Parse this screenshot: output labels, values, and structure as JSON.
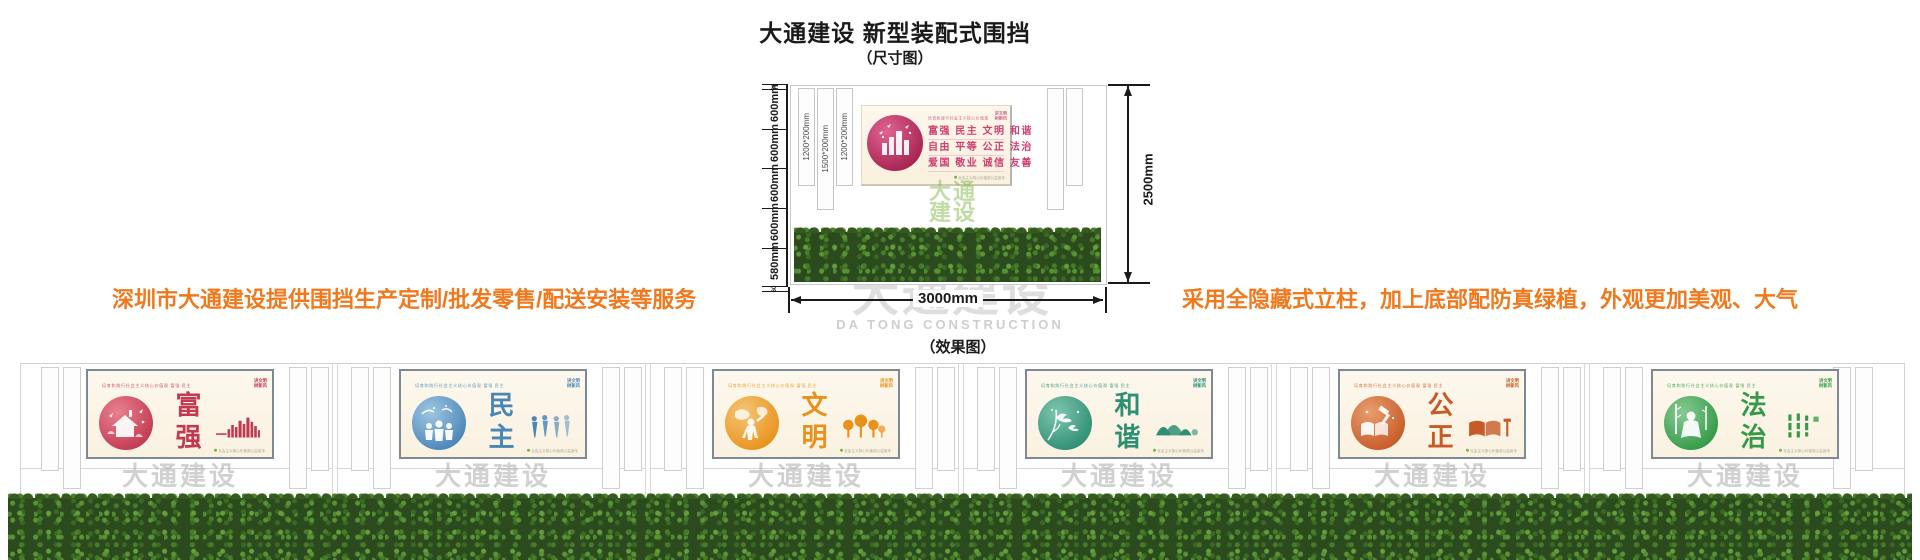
{
  "page": {
    "title": "大通建设 新型装配式围挡",
    "size_diagram_label": "（尺寸图）",
    "effect_diagram_label": "（效果图）",
    "left_note": "深圳市大通建设提供围挡生产定制/批发零售/配送安装等服务",
    "right_note": "采用全隐藏式立柱，加上底部配防真绿植，外观更加美观、大气",
    "note_color": "#f0791e"
  },
  "watermark": {
    "zh": "大通建设",
    "en": "DA TONG CONSTRUCTION",
    "green_lines": [
      "大通",
      "建设"
    ]
  },
  "diagram": {
    "total_height_label": "2500mm",
    "total_width_label": "3000mm",
    "left_segments": [
      {
        "label": "60",
        "mm": 60
      },
      {
        "label": "600mm",
        "mm": 600
      },
      {
        "label": "600mm",
        "mm": 600
      },
      {
        "label": "600mm",
        "mm": 600
      },
      {
        "label": "600mm",
        "mm": 600
      },
      {
        "label": "580mm",
        "mm": 580
      },
      {
        "label": "60",
        "mm": 60
      }
    ],
    "post_labels": [
      "1200*200mm",
      "1500*200mm",
      "1200*200mm"
    ],
    "banner": {
      "header": "培育和践行社会主义核心价值观",
      "value_rows": [
        "富强 民主 文明 和谐",
        "自由 平等 公正 法治",
        "爱国 敬业 诚信 友善"
      ],
      "corner_logo": [
        "讲文明",
        "树新风"
      ],
      "footer": "社会主义核心价值观公益宣传",
      "accent": "#cf3f72"
    }
  },
  "panel_common": {
    "top_strip": "培育和践行社会主义核心价值观  富强 民主 文明 和谐 自由 平等 公正 法治 爱国 敬业 诚信 友善",
    "corner_logo": [
      "讲文明",
      "树新风"
    ],
    "footer": "社会主义核心价值观公益宣传"
  },
  "panels": [
    {
      "value": "富强",
      "theme": "#c23a52",
      "light": "#e8818f",
      "circle_icon": "house",
      "side_icon": "city-bars"
    },
    {
      "value": "民主",
      "theme": "#4a86b8",
      "light": "#9fc6e2",
      "circle_icon": "globe-family",
      "side_icon": "figures"
    },
    {
      "value": "文明",
      "theme": "#e8921c",
      "light": "#f5c677",
      "circle_icon": "worldmap-figure",
      "side_icon": "trees"
    },
    {
      "value": "和谐",
      "theme": "#2e8f74",
      "light": "#7fc5ae",
      "circle_icon": "birds-branches",
      "side_icon": "mountains"
    },
    {
      "value": "公正",
      "theme": "#c75b28",
      "light": "#e89d6e",
      "circle_icon": "gavel-book",
      "side_icon": "book-gavel"
    },
    {
      "value": "法治",
      "theme": "#339a47",
      "light": "#87ca92",
      "circle_icon": "bamboo-figure",
      "side_icon": "bamboo-text"
    }
  ]
}
